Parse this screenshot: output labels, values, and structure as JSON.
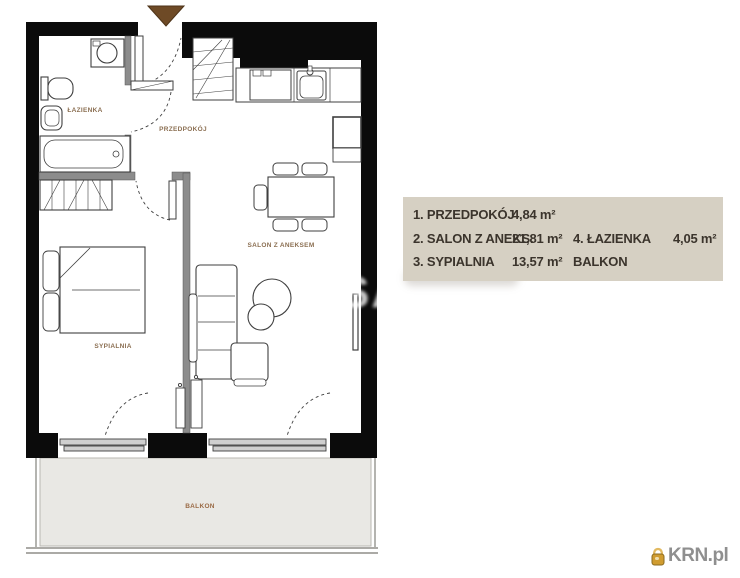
{
  "plan": {
    "rooms": [
      {
        "id": "lazienka",
        "label": "ŁAZIENKA"
      },
      {
        "id": "przedpokoj",
        "label": "PRZEDPOKÓJ"
      },
      {
        "id": "salon",
        "label": "SALON Z ANEKSEM"
      },
      {
        "id": "sypialnia",
        "label": "SYPIALNIA"
      },
      {
        "id": "balkon",
        "label": "BALKON"
      }
    ],
    "colors": {
      "wall": "#0b0b0b",
      "partition": "#8c8c8c",
      "furniture_stroke": "#3f3f3f",
      "balcony_fill": "#e9e8e4",
      "entrance_arrow": "#6e4a26",
      "room_label": "#8b6f52"
    }
  },
  "legend": {
    "background": "#d6d0c3",
    "text_color": "#3b342c",
    "rows": [
      {
        "c1": "1. PRZEDPOKÓJ",
        "a1": "4,84 m²",
        "c2": "",
        "a2": ""
      },
      {
        "c1": "2. SALON Z ANEKS.",
        "a1": "21,81 m²",
        "c2": "4. ŁAZIENKA",
        "a2": "4,05 m²"
      },
      {
        "c1": "3. SYPIALNIA",
        "a1": "13,57 m²",
        "c2": "BALKON",
        "a2": ""
      }
    ]
  },
  "watermark": {
    "visible_text": "SA"
  },
  "logo": {
    "text": "KRN.pl",
    "icon_color": "#d09c30",
    "text_color": "#8f8f8f"
  }
}
